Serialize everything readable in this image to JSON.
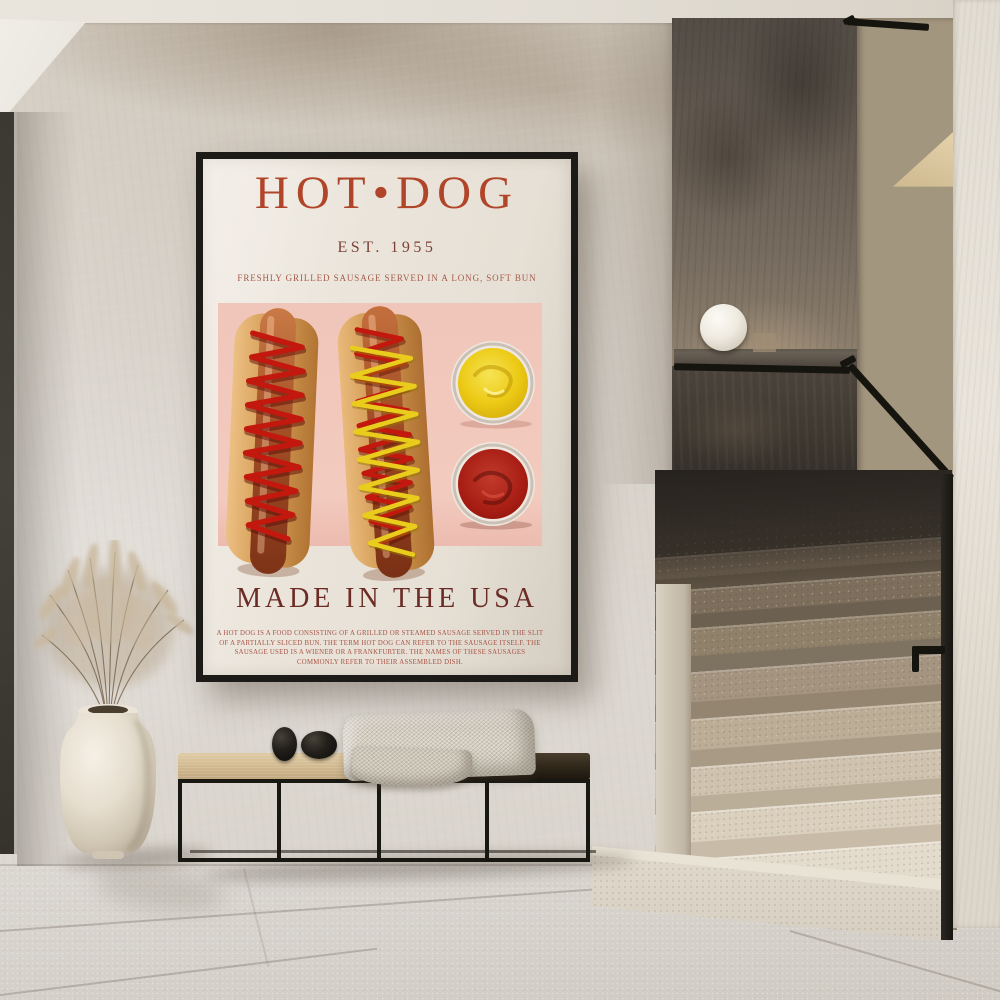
{
  "poster": {
    "title": "HOT•DOG",
    "established": "EST. 1955",
    "subtitle": "FRESHLY GRILLED SAUSAGE SERVED IN A LONG, SOFT BUN",
    "tagline": "MADE IN THE USA",
    "description": "A HOT DOG IS A FOOD CONSISTING OF A GRILLED OR STEAMED SAUSAGE SERVED IN THE SLIT OF A PARTIALLY SLICED BUN. THE TERM HOT DOG CAN REFER TO THE SAUSAGE ITSELF. THE SAUSAGE USED IS A WIENER OR A FRANKFURTER. THE NAMES OF THESE SAUSAGES COMMONLY REFER TO THEIR ASSEMBLED DISH.",
    "colors": {
      "title": "#b1452a",
      "established": "#7c4237",
      "subtitle": "#a65a49",
      "tagline": "#6b2c25",
      "description": "#a85446",
      "paper": "#e8e2d8",
      "panel_pink": "#f1c6ba",
      "mustard": "#e8c314",
      "ketchup": "#a91d15",
      "frame": "#1d1b18"
    }
  },
  "scene": {
    "objects": [
      "framed-poster",
      "white-sphere-lamp",
      "terrazzo-staircase",
      "black-handrail",
      "bench-with-blanket",
      "black-pebble-decor",
      "white-vase-with-dried-grass",
      "tiled-floor",
      "dark-wall-panel"
    ]
  }
}
